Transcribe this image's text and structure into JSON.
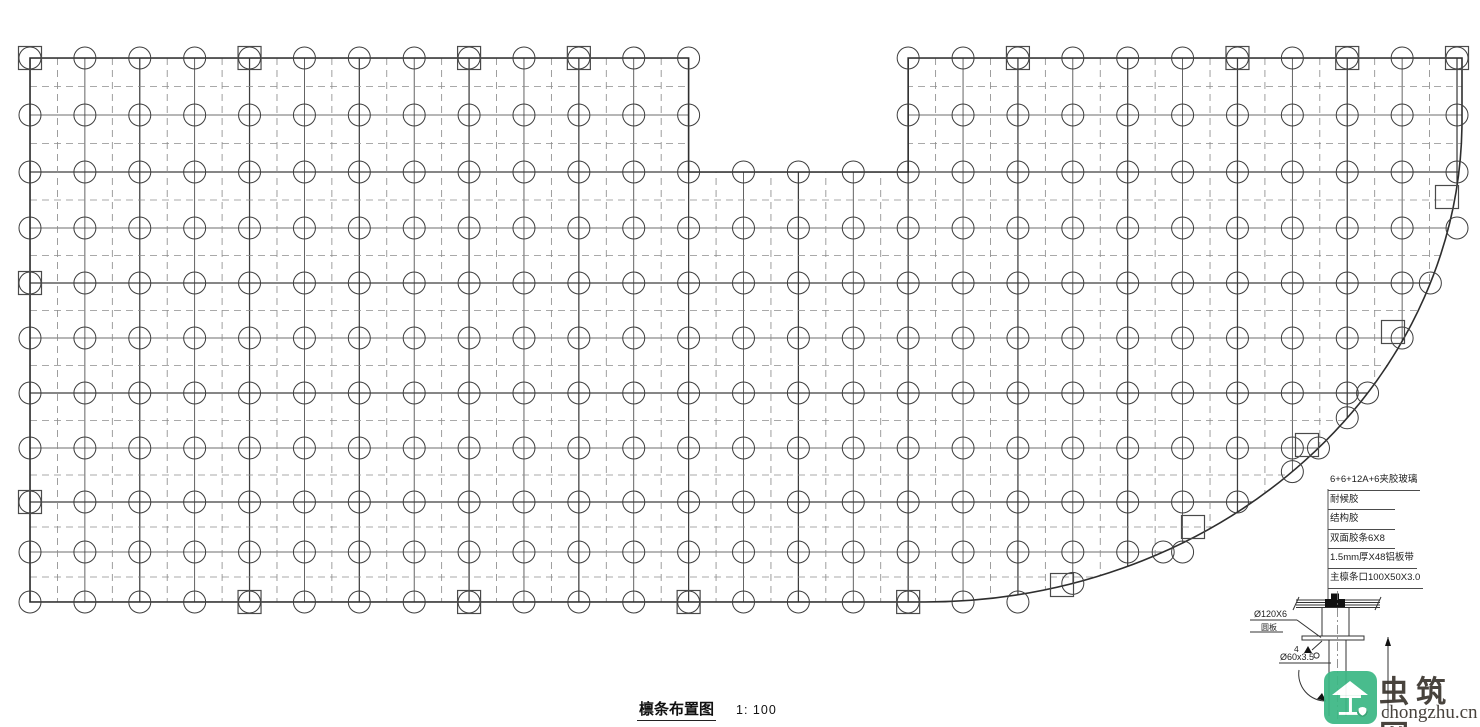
{
  "title": {
    "text": "檩条布置图",
    "scale": "1: 100"
  },
  "callouts": {
    "items": [
      "6+6+12A+6夹胶玻璃",
      "耐候胶",
      "结构胶",
      "双面胶条6X8",
      "1.5mm厚X48铝板带",
      "主檩条口100X50X3.0"
    ]
  },
  "detail": {
    "plate_dia": "Ø120X6",
    "plate_name": "圆板",
    "weld_size": "4",
    "pipe_spec": "Ø60x3.5"
  },
  "watermark": {
    "name": "虫筑网",
    "domain": "chongzhu.cn",
    "green": "#3cb885",
    "text_color": "#3b352f",
    "house_glyph": "工"
  },
  "plan": {
    "cols": {
      "start": 30,
      "step": 54.885,
      "count": 27
    },
    "rows": [
      58,
      115,
      172,
      228,
      283,
      338,
      393,
      448,
      502,
      552,
      602
    ],
    "notch": {
      "x1_col": 12,
      "x2_col": 16,
      "bottom_row": 2
    },
    "arc": {
      "cx": 925,
      "cy": 120,
      "rx": 537,
      "ry": 482
    },
    "right_x": 1462,
    "circle_r": 11,
    "square_size": 23,
    "squares": {
      "top_row_cols": [
        0,
        4,
        8,
        10,
        18,
        22,
        24,
        26
      ],
      "left_col_rows": [
        4,
        8
      ],
      "bottom_row_cols": [
        4,
        8,
        12,
        16
      ],
      "arc_points": [
        [
          1062,
          585
        ],
        [
          1193,
          527
        ],
        [
          1307,
          445
        ],
        [
          1393,
          332
        ],
        [
          1447,
          197
        ]
      ]
    },
    "colors": {
      "line": "#3d3d3d",
      "dash": "#8d8d8d",
      "boundary": "#2e2e2e",
      "marker": "#4a4a4a"
    }
  }
}
